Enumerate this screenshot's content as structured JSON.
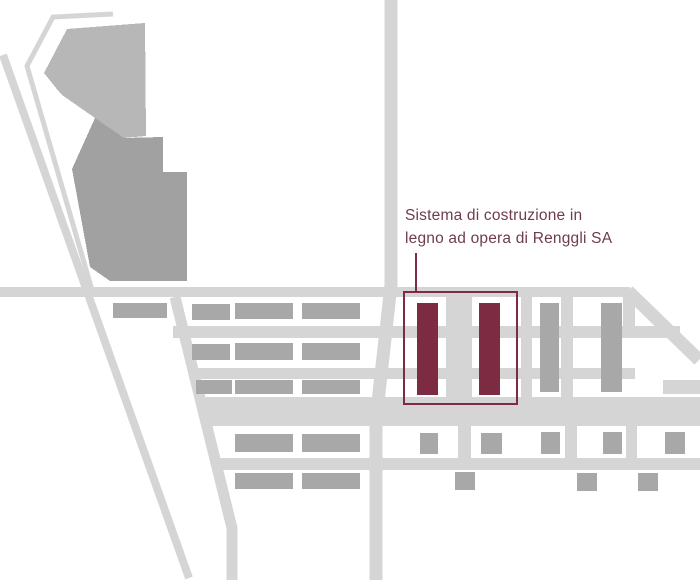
{
  "annotation": {
    "line1": "Sistema di costruzione in",
    "line2": "legno ad opera di Renggli SA"
  },
  "colors": {
    "bg": "#ffffff",
    "road": "#d5d5d5",
    "building": "#a8a8a8",
    "building-light": "#b7b7b7",
    "building-dark": "#a1a1a1",
    "highlight": "#7d2b42",
    "label": "#6e3c4e"
  }
}
